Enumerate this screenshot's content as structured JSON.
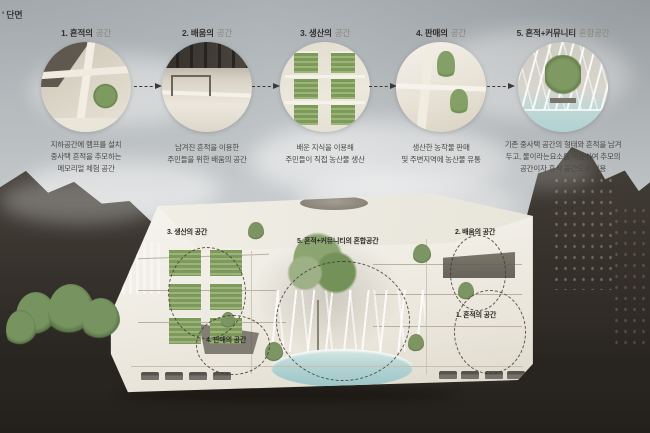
{
  "meta": {
    "section_title": "' 단면"
  },
  "steps": [
    {
      "title_strong": "1. 흔적의",
      "title_light": "공간",
      "caption": [
        "지하공간에 램프를 설치",
        "중사택 흔적을 추모하는",
        "메모리얼 체험 공간"
      ]
    },
    {
      "title_strong": "2. 배움의",
      "title_light": "공간",
      "caption": [
        "남겨진 흔적을 이용한",
        "주민들을 위한 배움의 공간"
      ]
    },
    {
      "title_strong": "3. 생산의",
      "title_light": "공간",
      "caption": [
        "배운 지식을 이용해",
        "주민들이 직접 농산물 생산"
      ]
    },
    {
      "title_strong": "4. 판매의",
      "title_light": "공간",
      "caption": [
        "생산한 농작물 판매",
        "및 주변지역에 농산물 유통"
      ]
    },
    {
      "title_strong": "5. 흔적+커뮤니티",
      "title_light": "혼합공간",
      "caption": [
        "기존 중사택 공간의 형태와 흔적을 남겨",
        "두고, 물이라는요소를 이용하여 추모의",
        "공간이자 휴식 공간으로 이용"
      ]
    }
  ],
  "zones": [
    {
      "id": "production",
      "label": "3. 생산의 공간"
    },
    {
      "id": "mixed",
      "label": "5. 흔적+커뮤니티의 혼합공간"
    },
    {
      "id": "learning",
      "label": "2. 배움의 공간"
    },
    {
      "id": "trace",
      "label": "1. 흔적의 공간"
    },
    {
      "id": "sales",
      "label": "4. 판매의 공간"
    }
  ],
  "colors": {
    "sky": "#c3c8ca",
    "terrain_dark": "#2a2622",
    "structure_white": "#f2f0e9",
    "vegetation_green": "#7d9a5c",
    "water_teal": "#aed2d2",
    "annotation_dark": "#37342e"
  }
}
